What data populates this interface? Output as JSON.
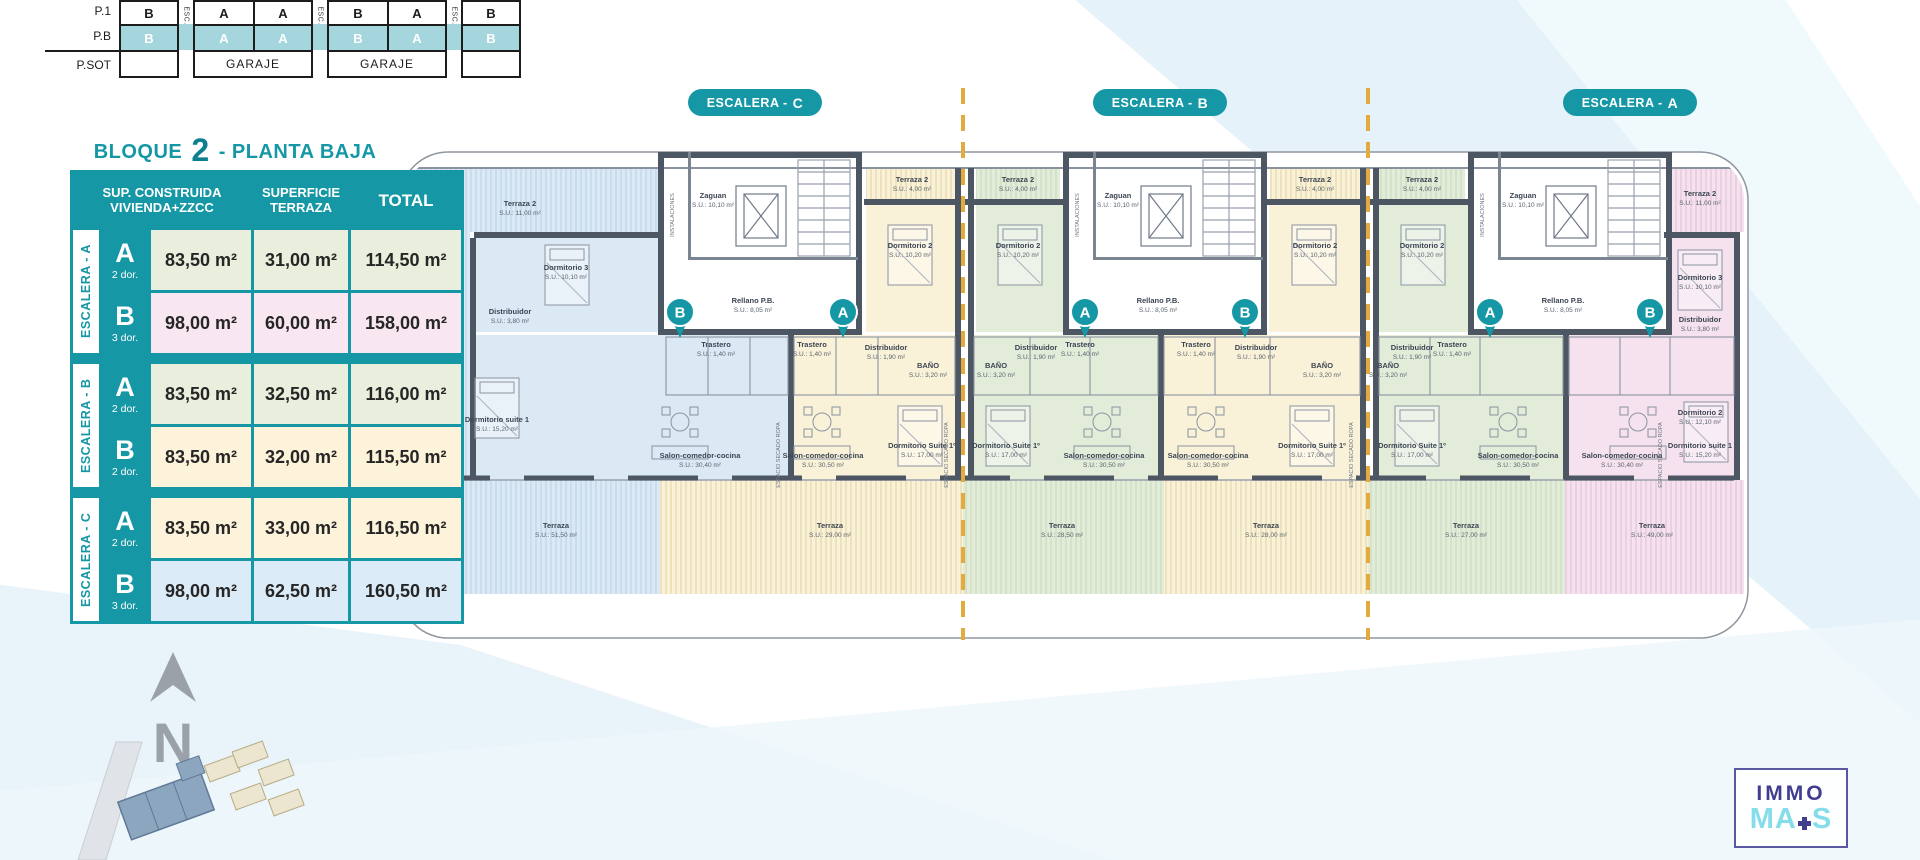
{
  "colors": {
    "accent_teal": "#1697a5",
    "stack_highlight": "#a5d6dd",
    "unit_blue": "#dbe9f5",
    "unit_yellow": "#faf2d8",
    "unit_green": "#e2ecd9",
    "unit_pink": "#f6e2ee",
    "dashed_line_yellow": "#e3aa3f",
    "wall": "#4d5663",
    "logo_purple": "#413e8f",
    "logo_cyan": "#85dceb"
  },
  "stack": {
    "row_labels": [
      "P.1",
      "P.B",
      "P.SOT"
    ],
    "esc": "ESC.",
    "garaje": "GARAJE",
    "p1": [
      "B",
      "A",
      "A",
      "B",
      "A",
      "B"
    ],
    "pb": [
      "B",
      "A",
      "A",
      "B",
      "A",
      "B"
    ]
  },
  "title": {
    "word": "BLOQUE",
    "number": "2",
    "rest": "- PLANTA BAJA"
  },
  "table": {
    "header": {
      "col1a": "SUP. CONSTRUIDA",
      "col1b": "VIVIENDA+ZZCC",
      "col2a": "SUPERFICIE",
      "col2b": "TERRAZA",
      "col3": "TOTAL"
    },
    "groups": [
      "ESCALERA - A",
      "ESCALERA - B",
      "ESCALERA - C"
    ],
    "rows": [
      {
        "type": "A",
        "dorms": "2 dor.",
        "built": "83,50 m²",
        "terrace": "31,00 m²",
        "total": "114,50 m²"
      },
      {
        "type": "B",
        "dorms": "3 dor.",
        "built": "98,00 m²",
        "terrace": "60,00 m²",
        "total": "158,00 m²"
      },
      {
        "type": "A",
        "dorms": "2 dor.",
        "built": "83,50 m²",
        "terrace": "32,50 m²",
        "total": "116,00 m²"
      },
      {
        "type": "B",
        "dorms": "2 dor.",
        "built": "83,50 m²",
        "terrace": "32,00 m²",
        "total": "115,50 m²"
      },
      {
        "type": "A",
        "dorms": "2 dor.",
        "built": "83,50 m²",
        "terrace": "33,00 m²",
        "total": "116,50 m²"
      },
      {
        "type": "B",
        "dorms": "3 dor.",
        "built": "98,00 m²",
        "terrace": "62,50 m²",
        "total": "160,50 m²"
      }
    ]
  },
  "plan": {
    "pills": [
      {
        "p": "ESCALERA -",
        "l": "C"
      },
      {
        "p": "ESCALERA -",
        "l": "B"
      },
      {
        "p": "ESCALERA -",
        "l": "A"
      }
    ],
    "pins": [
      "B",
      "A",
      "A",
      "B",
      "A",
      "B"
    ],
    "rooms": {
      "terraza2": "Terraza 2",
      "terraza2_end_su": "S.U.: 11,00 m²",
      "terraza2_in_su": "S.U.: 4,00 m²",
      "dormitorio2": "Dormitorio 2",
      "dormitorio2_su": "S.U.: 10,20 m²",
      "dormitorio2_end_su": "S.U.: 12,10 m²",
      "dormitorio3": "Dormitorio 3",
      "dormitorio3_su": "S.U.: 10,10 m²",
      "suite_end": "Dormitorio suite 1",
      "suite_end_su": "S.U.: 15,20 m²",
      "suite": "Dormitorio Suite 1º",
      "suite_su": "S.U.: 17,00 m²",
      "salon": "Salon-comedor-cocina",
      "salon_end_su": "S.U.: 30,40 m²",
      "salon_su": "S.U.: 30,50 m²",
      "trastero": "Trastero",
      "trastero_su": "S.U.: 1,40 m²",
      "bano": "BAÑO",
      "bano_su": "S.U.: 3,20 m²",
      "distribuidor": "Distribuidor",
      "distribuidor_su": "S.U.: 1,90 m²",
      "distribuidor_end_su": "S.U.: 3,80 m²",
      "zaguan": "Zaguan",
      "zaguan_su": "S.U.: 10,10 m²",
      "rellano": "Rellano P.B.",
      "rellano_su": "S.U.: 8,05 m²",
      "instalaciones": "INSTALACIONES",
      "secado": "ESPACIO SECADO ROPA",
      "terraza": "Terraza"
    },
    "terrazas_su": [
      "S.U.: 51,50 m²",
      "S.U.: 29,00 m²",
      "S.U.: 28,50 m²",
      "S.U.: 28,00 m²",
      "S.U.: 27,00 m²",
      "S.U.: 49,00 m²"
    ]
  },
  "compass": {
    "letter": "N"
  },
  "logo": {
    "immo": "IMMO",
    "ma": "MA",
    "s": "S"
  }
}
